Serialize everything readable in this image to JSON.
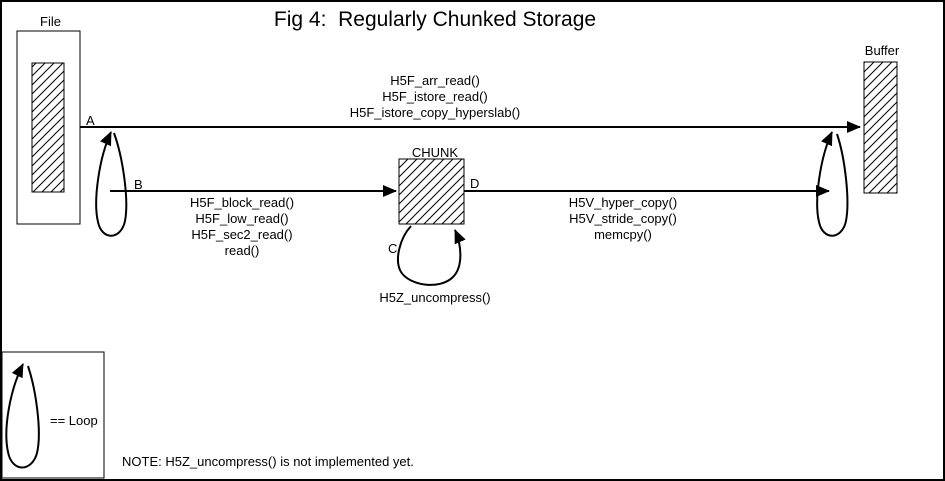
{
  "title": "Fig 4:  Regularly Chunked Storage",
  "boxes": {
    "file": "File",
    "chunk": "CHUNK",
    "buffer": "Buffer"
  },
  "arrows": {
    "a": {
      "label": "A",
      "functions": [
        "H5F_arr_read()",
        "H5F_istore_read()",
        "H5F_istore_copy_hyperslab()"
      ]
    },
    "b": {
      "label": "B",
      "functions": [
        "H5F_block_read()",
        "H5F_low_read()",
        "H5F_sec2_read()",
        "read()"
      ]
    },
    "c": {
      "label": "C",
      "functions": [
        "H5Z_uncompress()"
      ]
    },
    "d": {
      "label": "D",
      "functions": [
        "H5V_hyper_copy()",
        "H5V_stride_copy()",
        "memcpy()"
      ]
    }
  },
  "legend": {
    "label": "== Loop"
  },
  "note": "NOTE: H5Z_uncompress() is not implemented yet.",
  "colors": {
    "ink": "#000000",
    "background": "#ffffff"
  }
}
